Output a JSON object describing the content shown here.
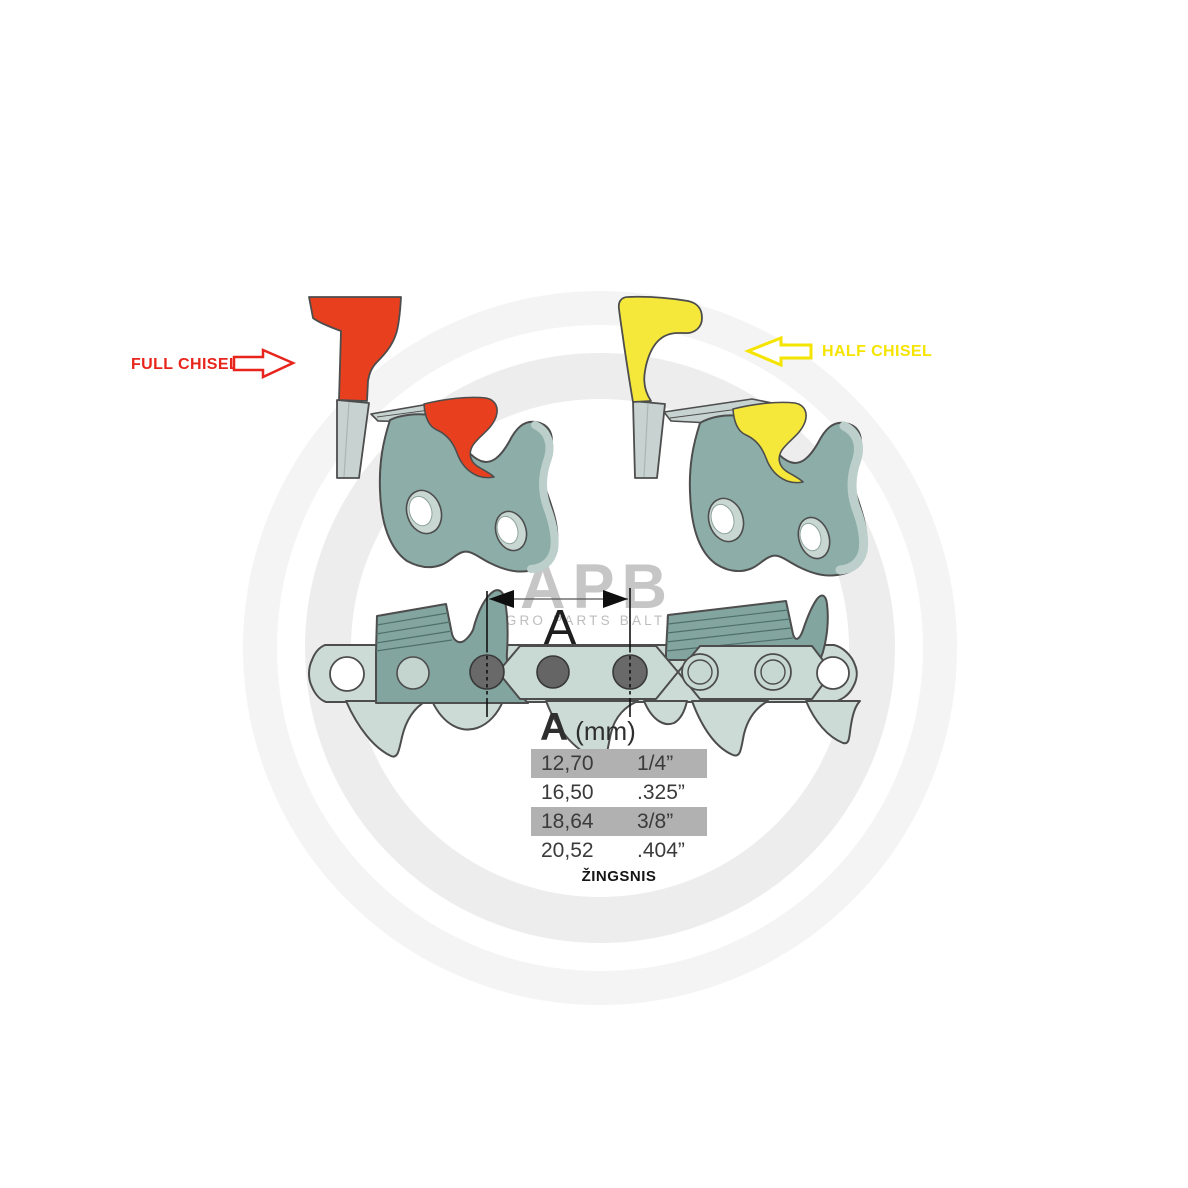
{
  "labels": {
    "full_chisel": "FULL CHISEL",
    "half_chisel": "HALF CHISEL",
    "dimension_letter": "A"
  },
  "watermark": {
    "brand": "APB",
    "subtitle": "AGRO PARTS BALTIJA"
  },
  "pitch_table": {
    "header_letter": "A",
    "header_unit": "(mm)",
    "caption": "ŽINGSNIS",
    "rows": [
      {
        "mm": "12,70",
        "inch": "1/4”",
        "highlighted": true
      },
      {
        "mm": "16,50",
        "inch": ".325”",
        "highlighted": false
      },
      {
        "mm": "18,64",
        "inch": "3/8”",
        "highlighted": true
      },
      {
        "mm": "20,52",
        "inch": ".404”",
        "highlighted": false
      }
    ]
  },
  "colors": {
    "full_chisel_red": "#e8251c",
    "cutter_red": "#e8401e",
    "half_chisel_yellow": "#f5e400",
    "cutter_yellow": "#f6e83b",
    "link_body_teal": "#8cada8",
    "chain_strap_light": "#ccdbd6",
    "chain_cutter_dark": "#82a5a0",
    "rivet_gray": "#696969",
    "table_highlight_gray": "#b1b1b1"
  }
}
